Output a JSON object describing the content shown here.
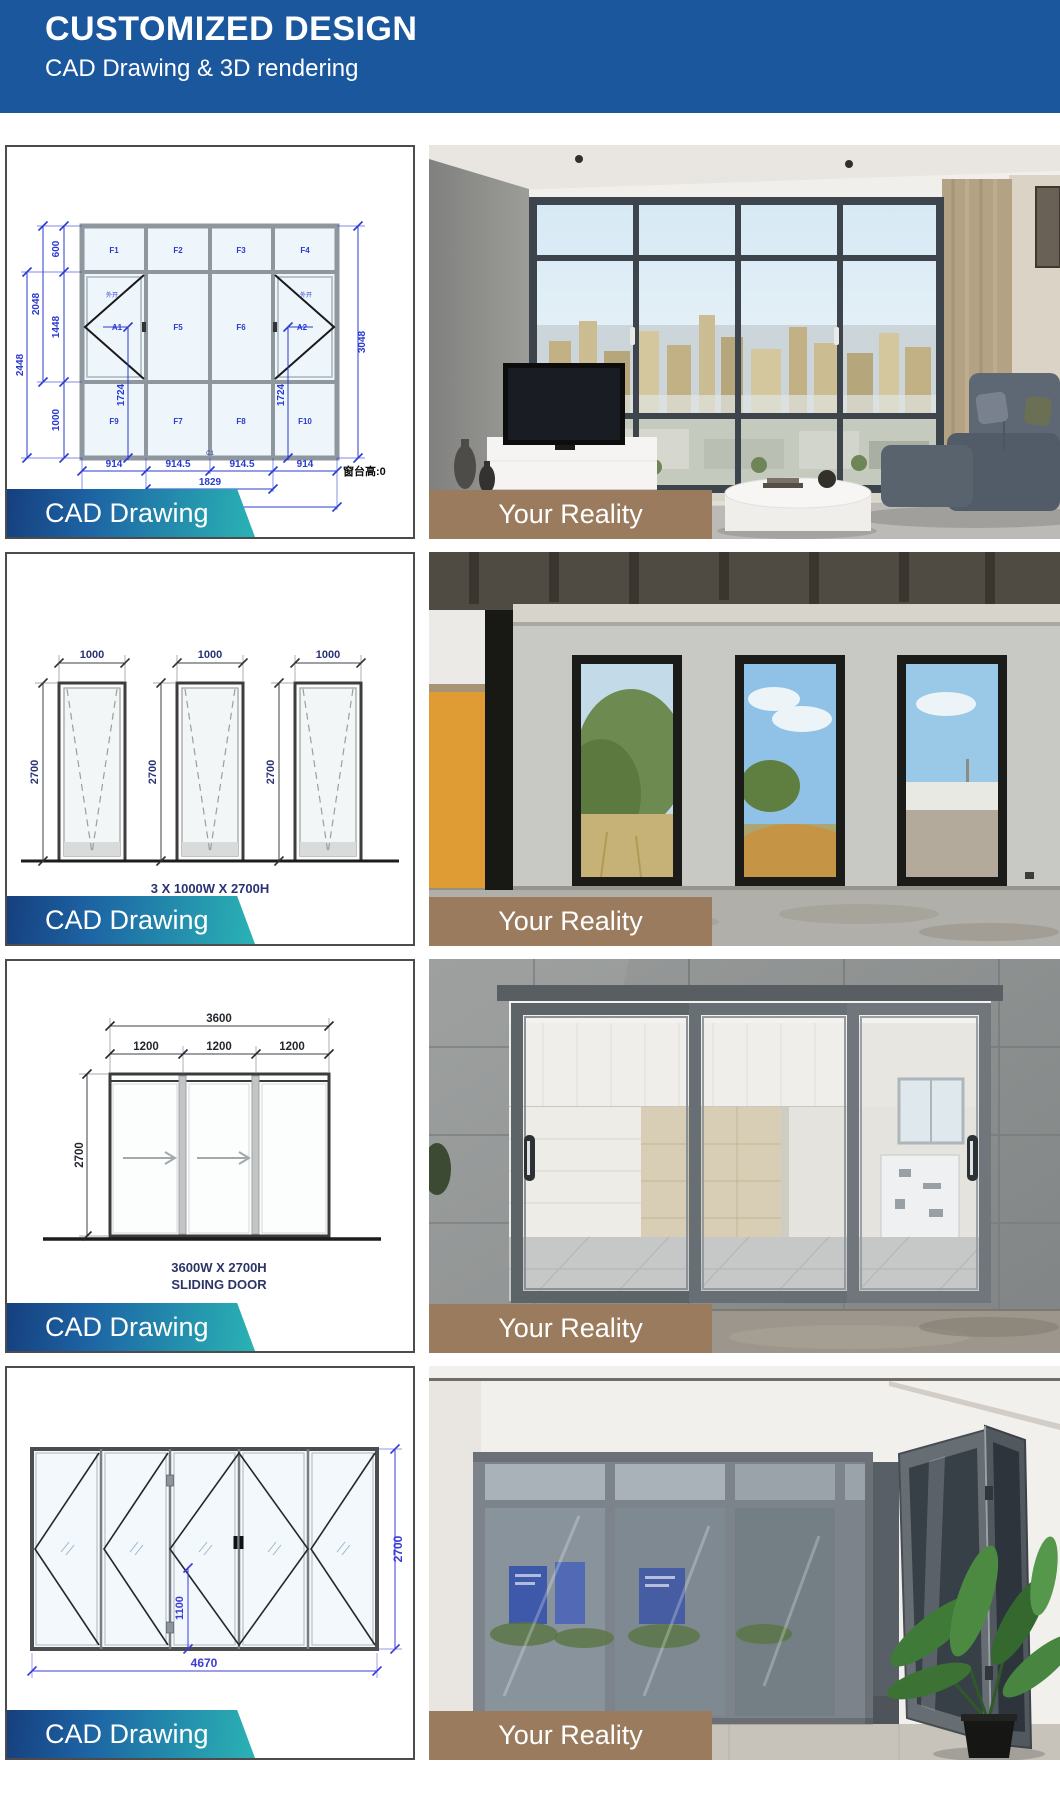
{
  "header": {
    "title": "CUSTOMIZED DESIGN",
    "subtitle": "CAD Drawing & 3D rendering"
  },
  "colors": {
    "header_bg": "#1a579d",
    "ribbon_gradient_start": "#163f7e",
    "ribbon_gradient_end": "#2ab3b4",
    "reality_band_brown": "#9b7b5d",
    "cad_dim_blue": "#2b3bd2",
    "cad_dim_navy": "#2c3566",
    "cad_dim_purple": "#3b3bd8"
  },
  "rows": [
    {
      "cad_label": "CAD Drawing",
      "photo_label": "Your Reality"
    },
    {
      "cad_label": "CAD Drawing",
      "photo_label": "Your Reality"
    },
    {
      "cad_label": "CAD Drawing",
      "photo_label": "Your Reality"
    },
    {
      "cad_label": "CAD Drawing",
      "photo_label": "Your Reality"
    }
  ],
  "cad1": {
    "top_cells": [
      "F1",
      "F2",
      "F3",
      "F4"
    ],
    "mid_cells": [
      "A1",
      "F5",
      "F6",
      "A2"
    ],
    "bottom_cells": [
      "F9",
      "F7",
      "F8",
      "F10"
    ],
    "open_note_left": "外开",
    "open_note_right": "外开",
    "left_inner_dims": [
      "600",
      "1448",
      "1000"
    ],
    "left_outer_dims": [
      "2048",
      "2448"
    ],
    "right_total_dim": "3048",
    "sash_dim_left": "1724",
    "sash_dim_right": "1724",
    "bottom_dims": [
      "914",
      "914.5",
      "914.5",
      "914"
    ],
    "bottom_mid_dim": "1829",
    "bottom_total_dim": "3657",
    "center_label": "C1",
    "sill_note": "窗台高:0"
  },
  "cad2": {
    "width_dims": [
      "1000",
      "1000",
      "1000"
    ],
    "height_dims": [
      "2700",
      "2700",
      "2700"
    ],
    "caption": "3 X 1000W X 2700H"
  },
  "cad3": {
    "total_width_dim": "3600",
    "panel_dims": [
      "1200",
      "1200",
      "1200"
    ],
    "height_dim": "2700",
    "caption_line1": "3600W X 2700H",
    "caption_line2": "SLIDING DOOR"
  },
  "cad4": {
    "total_width_dim": "4670",
    "height_dim": "2700",
    "handle_height_dim": "1100"
  }
}
